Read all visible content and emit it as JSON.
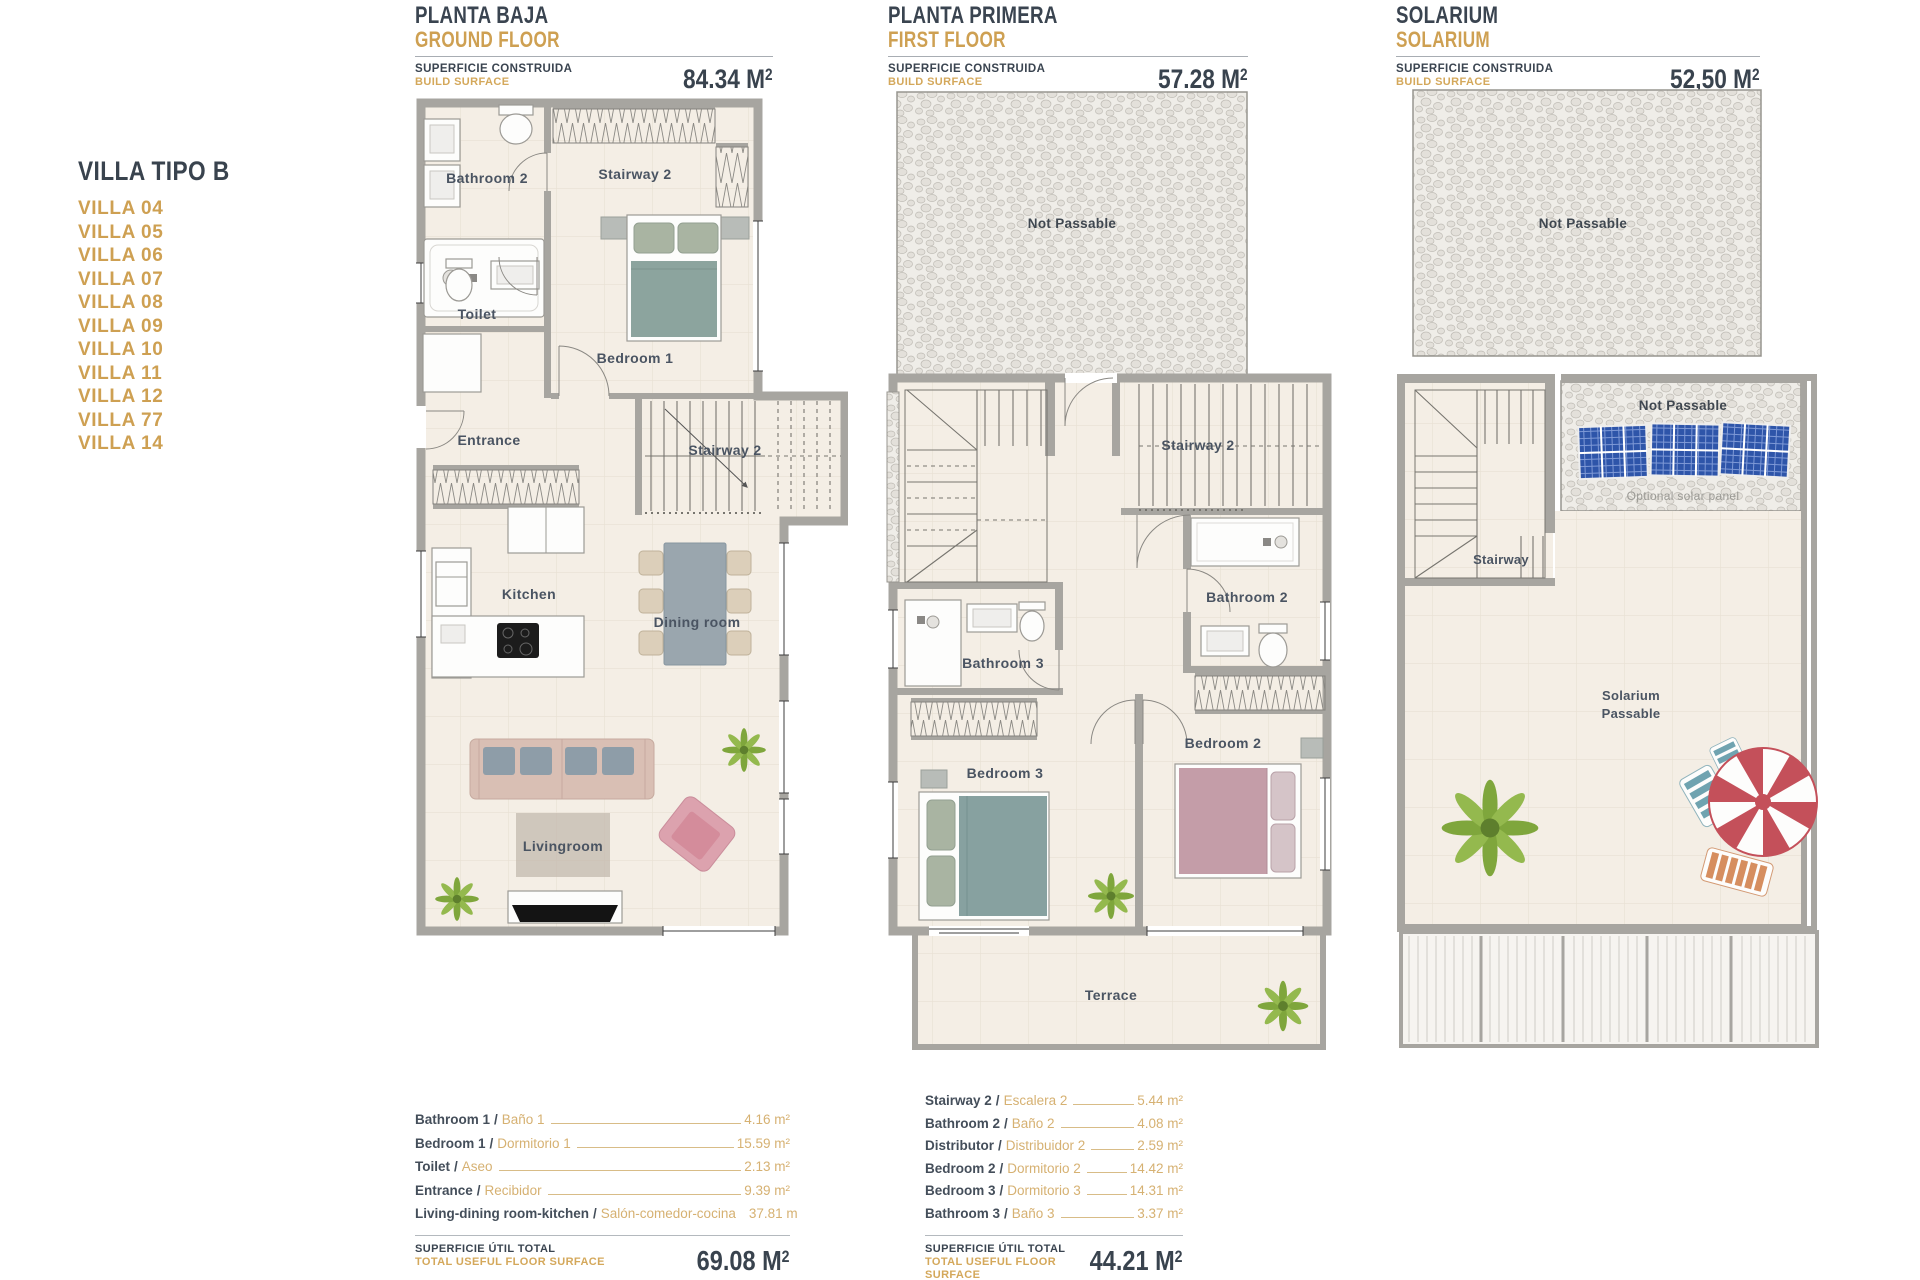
{
  "palette": {
    "accent_gold": "#CEA052",
    "dark_text": "#3A4450",
    "wall_gray": "#A7A5A0",
    "floor_cream": "#F4EEE5",
    "bed_sage": "#8CA49E",
    "bed_teal": "#87A1A0",
    "bed_mauve": "#C49DA8",
    "sofa_pink": "#D9BFB4",
    "armchair_pink": "#DCA2AE",
    "solar_blue": "#2E55A9",
    "plant_green": "#7FA63C",
    "umbrella_red": "#C4505A"
  },
  "sidebar": {
    "title": "VILLA TIPO B",
    "villas": [
      "VILLA 04",
      "VILLA 05",
      "VILLA 06",
      "VILLA 07",
      "VILLA 08",
      "VILLA 09",
      "VILLA 10",
      "VILLA 11",
      "VILLA 12",
      "VILLA 77",
      "VILLA 14"
    ]
  },
  "headers": {
    "surface_label_es": "SUPERFICIE CONSTRUIDA",
    "surface_label_en": "BUILD SURFACE",
    "ground": {
      "title_es": "PLANTA BAJA",
      "title_en": "GROUND FLOOR",
      "value": "84.34 M",
      "sup": "2"
    },
    "first": {
      "title_es": "PLANTA PRIMERA",
      "title_en": "FIRST FLOOR",
      "value": "57.28 M",
      "sup": "2"
    },
    "solarium": {
      "title_es": "SOLARIUM",
      "title_en": "SOLARIUM",
      "value": "52,50 M",
      "sup": "2"
    }
  },
  "plans": {
    "ground": {
      "labels": {
        "bathroom2": "Bathroom 2",
        "stairway2_top": "Stairway 2",
        "toilet": "Toilet",
        "bedroom1": "Bedroom 1",
        "entrance": "Entrance",
        "stairway2": "Stairway 2",
        "kitchen": "Kitchen",
        "dining_room": "Dining room",
        "livingroom": "Livingroom"
      }
    },
    "first": {
      "labels": {
        "not_passable": "Not Passable",
        "stairway2": "Stairway 2",
        "bathroom2": "Bathroom 2",
        "bathroom3": "Bathroom 3",
        "bedroom2": "Bedroom 2",
        "bedroom3": "Bedroom 3",
        "terrace": "Terrace"
      }
    },
    "solarium": {
      "labels": {
        "not_passable_top": "Not Passable",
        "not_passable_panels": "Not Passable",
        "optional_solar": "Optional solar panel",
        "stairway": "Stairway",
        "solarium": "Solarium",
        "passable": "Passable"
      }
    }
  },
  "tables": {
    "separator": "/",
    "total_label_es": "SUPERFICIE ÚTIL TOTAL",
    "total_label_en": "TOTAL USEFUL FLOOR SURFACE",
    "ground": {
      "rows": [
        {
          "en": "Bathroom 1",
          "es": "Baño 1",
          "value": "4.16 m²"
        },
        {
          "en": "Bedroom 1",
          "es": "Dormitorio 1",
          "value": "15.59 m²"
        },
        {
          "en": "Toilet",
          "es": "Aseo",
          "value": "2.13 m²"
        },
        {
          "en": "Entrance",
          "es": "Recibidor",
          "value": "9.39 m²"
        },
        {
          "en": "Living-dining room-kitchen",
          "es": "Salón-comedor-cocina",
          "value": "37.81 m"
        }
      ],
      "total": "69.08 M",
      "sup": "2"
    },
    "first": {
      "rows": [
        {
          "en": "Stairway 2",
          "es": "Escalera 2",
          "value": "5.44 m²"
        },
        {
          "en": "Bathroom 2",
          "es": "Baño 2",
          "value": "4.08 m²"
        },
        {
          "en": "Distributor",
          "es": "Distribuidor 2",
          "value": "2.59 m²"
        },
        {
          "en": "Bedroom 2",
          "es": "Dormitorio 2",
          "value": "14.42 m²"
        },
        {
          "en": "Bedroom 3",
          "es": "Dormitorio 3",
          "value": "14.31 m²"
        },
        {
          "en": "Bathroom 3",
          "es": "Baño 3",
          "value": "3.37 m²"
        }
      ],
      "total": "44.21 M",
      "sup": "2"
    }
  }
}
